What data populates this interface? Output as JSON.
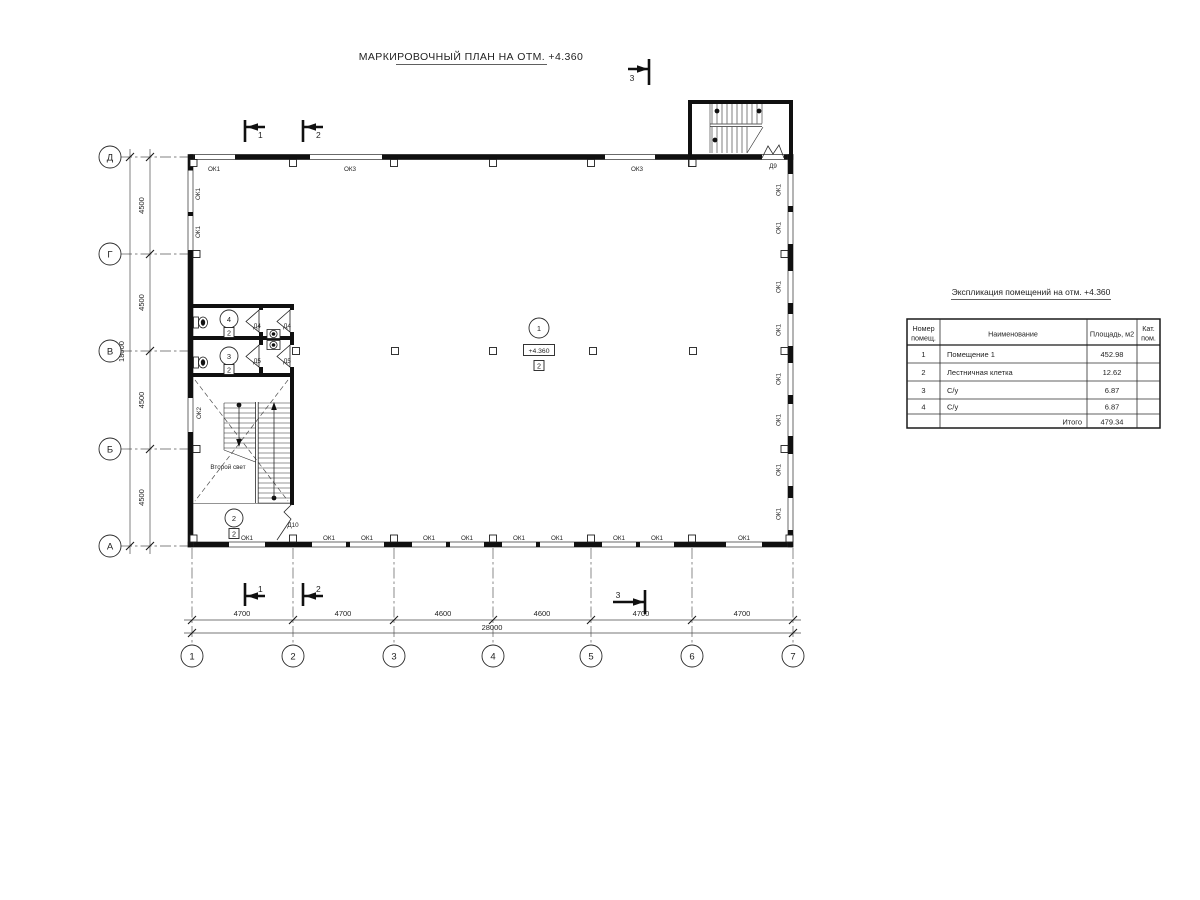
{
  "title": "МАРКИРОВОЧНЫЙ ПЛАН НА ОТМ. +4.360",
  "axes": {
    "letters": [
      "Д",
      "Г",
      "В",
      "Б",
      "А"
    ],
    "numbers": [
      "1",
      "2",
      "3",
      "4",
      "5",
      "6",
      "7"
    ]
  },
  "dims": {
    "v4500": "4500",
    "v18000": "18000",
    "h4700": "4700",
    "h4600": "4600",
    "h28000": "28000"
  },
  "marks": {
    "ok1": "ОК1",
    "ok2": "ОК2",
    "ok3": "ОК3",
    "d4": "Д4",
    "d5": "Д5",
    "d9": "Д9",
    "d10": "Д10"
  },
  "rooms": {
    "r1": "1",
    "r2": "2",
    "r3": "3",
    "r4": "4",
    "cat2": "2",
    "elevation": "+4.360",
    "void": "Второй свет"
  },
  "sections": {
    "s1": "1",
    "s2": "2",
    "s3": "3"
  },
  "table": {
    "title": "Экспликация помещений на отм. +4.360",
    "header": {
      "num1": "Номер",
      "num2": "помещ.",
      "name": "Наименование",
      "area": "Площадь,  м2",
      "cat1": "Кат.",
      "cat2": "пом."
    },
    "rows": [
      {
        "num": "1",
        "name": "Помещение 1",
        "area": "452.98"
      },
      {
        "num": "2",
        "name": "Лестничная клетка",
        "area": "12.62"
      },
      {
        "num": "3",
        "name": "С/у",
        "area": "6.87"
      },
      {
        "num": "4",
        "name": "С/у",
        "area": "6.87"
      }
    ],
    "total_label": "Итого",
    "total_value": "479.34"
  }
}
